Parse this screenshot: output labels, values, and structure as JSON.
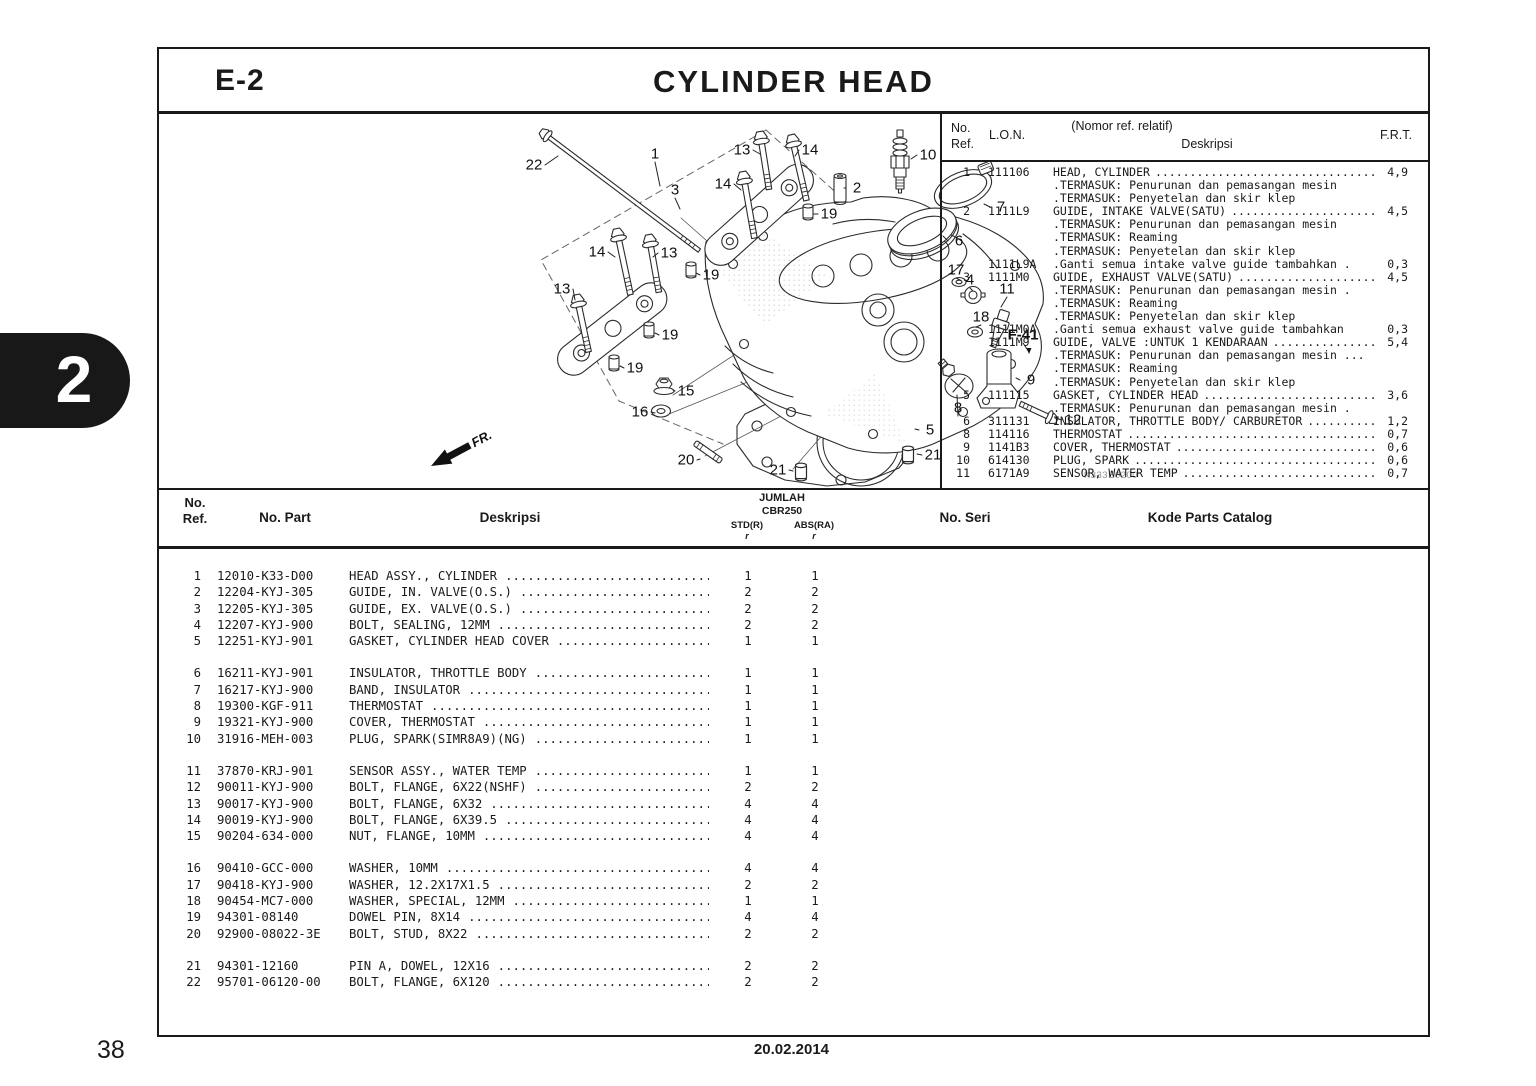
{
  "page": {
    "section_code": "E-2",
    "title": "CYLINDER HEAD",
    "page_number": "38",
    "date": "20.02.2014",
    "chapter_tab": "2"
  },
  "diagram": {
    "code": "K333E0200",
    "fr_label": "FR.",
    "callouts": [
      {
        "t": "22",
        "x": 131,
        "y": 51,
        "tx": 155,
        "ty": 42
      },
      {
        "t": "1",
        "x": 252,
        "y": 40,
        "tx": 257,
        "ty": 72
      },
      {
        "t": "13",
        "x": 339,
        "y": 36,
        "tx": 357,
        "ty": 40
      },
      {
        "t": "14",
        "x": 407,
        "y": 36,
        "tx": 392,
        "ty": 42
      },
      {
        "t": "3",
        "x": 272,
        "y": 76,
        "tx": 277,
        "ty": 95
      },
      {
        "t": "14",
        "x": 320,
        "y": 70,
        "tx": 338,
        "ty": 76
      },
      {
        "t": "2",
        "x": 454,
        "y": 74,
        "tx": 441,
        "ty": 74
      },
      {
        "t": "10",
        "x": 525,
        "y": 41,
        "tx": 508,
        "ty": 45
      },
      {
        "t": "19",
        "x": 426,
        "y": 100,
        "tx": 411,
        "ty": 100
      },
      {
        "t": "7",
        "x": 598,
        "y": 93,
        "tx": 581,
        "ty": 90
      },
      {
        "t": "6",
        "x": 556,
        "y": 127,
        "tx": 540,
        "ty": 122
      },
      {
        "t": "14",
        "x": 194,
        "y": 138,
        "tx": 212,
        "ty": 143
      },
      {
        "t": "13",
        "x": 266,
        "y": 139,
        "tx": 250,
        "ty": 143
      },
      {
        "t": "13",
        "x": 159,
        "y": 175,
        "tx": 172,
        "ty": 186
      },
      {
        "t": "19",
        "x": 308,
        "y": 161,
        "tx": 293,
        "ty": 159
      },
      {
        "t": "19",
        "x": 267,
        "y": 221,
        "tx": 252,
        "ty": 219
      },
      {
        "t": "19",
        "x": 232,
        "y": 254,
        "tx": 217,
        "ty": 252
      },
      {
        "t": "15",
        "x": 283,
        "y": 277,
        "tx": 270,
        "ty": 276
      },
      {
        "t": "16",
        "x": 237,
        "y": 298,
        "tx": 252,
        "ty": 299
      },
      {
        "t": "17",
        "x": 553,
        "y": 156,
        "tx": 557,
        "ty": 166
      },
      {
        "t": "4",
        "x": 567,
        "y": 166,
        "tx": 570,
        "ty": 177
      },
      {
        "t": "11",
        "x": 604,
        "y": 175,
        "tx": 598,
        "ty": 193
      },
      {
        "t": "18",
        "x": 578,
        "y": 203,
        "tx": 573,
        "ty": 213
      },
      {
        "t": "F-41",
        "x": 620,
        "y": 221,
        "b": true,
        "tx": 626,
        "ty": 238
      },
      {
        "t": "9",
        "x": 628,
        "y": 266,
        "tx": 613,
        "ty": 264
      },
      {
        "t": "8",
        "x": 555,
        "y": 294,
        "tx": 554,
        "ty": 281
      },
      {
        "t": "12",
        "x": 670,
        "y": 306,
        "tx": 652,
        "ty": 304
      },
      {
        "t": "5",
        "x": 527,
        "y": 316,
        "tx": 512,
        "ty": 315
      },
      {
        "t": "21",
        "x": 530,
        "y": 341,
        "tx": 514,
        "ty": 340
      },
      {
        "t": "20",
        "x": 283,
        "y": 346,
        "tx": 297,
        "ty": 345
      },
      {
        "t": "21",
        "x": 375,
        "y": 356,
        "tx": 390,
        "ty": 357
      }
    ]
  },
  "lon_table": {
    "header": {
      "ref_line1": "No.",
      "ref_line2": "Ref.",
      "lon": "L.O.N.",
      "desc_line1": "(Nomor ref. relatif)",
      "desc_line2": "Deskripsi",
      "frt": "F.R.T."
    },
    "rows": [
      {
        "ref": "1",
        "lon": "111106",
        "desc": "HEAD, CYLINDER",
        "frt": "4,9",
        "sub": [
          ".TERMASUK: Penurunan dan pemasangan mesin",
          ".TERMASUK: Penyetelan dan skir klep"
        ]
      },
      {
        "ref": "2",
        "lon": "1111L9",
        "desc": "GUIDE, INTAKE VALVE(SATU)",
        "frt": "4,5",
        "sub": [
          ".TERMASUK: Penurunan dan pemasangan mesin",
          ".TERMASUK: Reaming",
          ".TERMASUK: Penyetelan dan skir klep"
        ]
      },
      {
        "ref": "",
        "lon": "1111L9A",
        "desc": ".Ganti semua intake valve guide tambahkan .",
        "frt": "0,3",
        "leader": false
      },
      {
        "ref": "3",
        "lon": "1111M0",
        "desc": "GUIDE, EXHAUST VALVE(SATU)",
        "frt": "4,5",
        "sub": [
          ".TERMASUK: Penurunan dan pemasangan mesin .",
          ".TERMASUK: Reaming",
          ".TERMASUK: Penyetelan dan skir klep"
        ]
      },
      {
        "ref": "",
        "lon": "1111M0A",
        "desc": ".Ganti semua exhaust valve guide tambahkan",
        "frt": "0,3",
        "leader": false
      },
      {
        "ref": "",
        "lon": "1111M9",
        "desc": "GUIDE, VALVE :UNTUK 1 KENDARAAN",
        "frt": "5,4",
        "sub": [
          ".TERMASUK: Penurunan dan pemasangan mesin ...",
          ".TERMASUK: Reaming",
          ".TERMASUK: Penyetelan dan skir klep"
        ]
      },
      {
        "ref": "5",
        "lon": "111115",
        "desc": "GASKET, CYLINDER HEAD",
        "frt": "3,6",
        "sub": [
          ".TERMASUK: Penurunan dan pemasangan mesin ."
        ]
      },
      {
        "ref": "6",
        "lon": "311131",
        "desc": "INSULATOR, THROTTLE BODY/ CARBURETOR",
        "frt": "1,2"
      },
      {
        "ref": "8",
        "lon": "114116",
        "desc": "THERMOSTAT",
        "frt": "0,7"
      },
      {
        "ref": "9",
        "lon": "1141B3",
        "desc": "COVER, THERMOSTAT",
        "frt": "0,6"
      },
      {
        "ref": "10",
        "lon": "614130",
        "desc": "PLUG, SPARK",
        "frt": "0,6"
      },
      {
        "ref": "11",
        "lon": "6171A9",
        "desc": "SENSOR, WATER TEMP",
        "frt": "0,7"
      }
    ]
  },
  "parts_table": {
    "header": {
      "ref_line1": "No.",
      "ref_line2": "Ref.",
      "part": "No. Part",
      "desc": "Deskripsi",
      "jumlah": "JUMLAH",
      "model": "CBR250",
      "std": "STD(R)",
      "abs": "ABS(RA)",
      "std_note": "r",
      "abs_note": "r",
      "seri": "No. Seri",
      "kode": "Kode Parts Catalog"
    },
    "groups": [
      [
        {
          "ref": "1",
          "part": "12010-K33-D00",
          "desc": "HEAD ASSY., CYLINDER",
          "std": "1",
          "abs": "1"
        },
        {
          "ref": "2",
          "part": "12204-KYJ-305",
          "desc": "GUIDE, IN. VALVE(O.S.)",
          "std": "2",
          "abs": "2"
        },
        {
          "ref": "3",
          "part": "12205-KYJ-305",
          "desc": "GUIDE, EX. VALVE(O.S.)",
          "std": "2",
          "abs": "2"
        },
        {
          "ref": "4",
          "part": "12207-KYJ-900",
          "desc": "BOLT, SEALING, 12MM",
          "std": "2",
          "abs": "2"
        },
        {
          "ref": "5",
          "part": "12251-KYJ-901",
          "desc": "GASKET, CYLINDER HEAD COVER",
          "std": "1",
          "abs": "1"
        }
      ],
      [
        {
          "ref": "6",
          "part": "16211-KYJ-901",
          "desc": "INSULATOR, THROTTLE BODY",
          "std": "1",
          "abs": "1"
        },
        {
          "ref": "7",
          "part": "16217-KYJ-900",
          "desc": "BAND, INSULATOR",
          "std": "1",
          "abs": "1"
        },
        {
          "ref": "8",
          "part": "19300-KGF-911",
          "desc": "THERMOSTAT",
          "std": "1",
          "abs": "1"
        },
        {
          "ref": "9",
          "part": "19321-KYJ-900",
          "desc": "COVER, THERMOSTAT",
          "std": "1",
          "abs": "1"
        },
        {
          "ref": "10",
          "part": "31916-MEH-003",
          "desc": "PLUG, SPARK(SIMR8A9)(NG)",
          "std": "1",
          "abs": "1"
        }
      ],
      [
        {
          "ref": "11",
          "part": "37870-KRJ-901",
          "desc": "SENSOR ASSY., WATER TEMP",
          "std": "1",
          "abs": "1"
        },
        {
          "ref": "12",
          "part": "90011-KYJ-900",
          "desc": "BOLT, FLANGE, 6X22(NSHF)",
          "std": "2",
          "abs": "2"
        },
        {
          "ref": "13",
          "part": "90017-KYJ-900",
          "desc": "BOLT, FLANGE, 6X32",
          "std": "4",
          "abs": "4"
        },
        {
          "ref": "14",
          "part": "90019-KYJ-900",
          "desc": "BOLT, FLANGE, 6X39.5",
          "std": "4",
          "abs": "4"
        },
        {
          "ref": "15",
          "part": "90204-634-000",
          "desc": "NUT, FLANGE, 10MM",
          "std": "4",
          "abs": "4"
        }
      ],
      [
        {
          "ref": "16",
          "part": "90410-GCC-000",
          "desc": "WASHER, 10MM",
          "std": "4",
          "abs": "4"
        },
        {
          "ref": "17",
          "part": "90418-KYJ-900",
          "desc": "WASHER, 12.2X17X1.5",
          "std": "2",
          "abs": "2"
        },
        {
          "ref": "18",
          "part": "90454-MC7-000",
          "desc": "WASHER, SPECIAL, 12MM",
          "std": "1",
          "abs": "1"
        },
        {
          "ref": "19",
          "part": "94301-08140",
          "desc": "DOWEL PIN, 8X14",
          "std": "4",
          "abs": "4"
        },
        {
          "ref": "20",
          "part": "92900-08022-3E",
          "desc": "BOLT, STUD, 8X22",
          "std": "2",
          "abs": "2"
        }
      ],
      [
        {
          "ref": "21",
          "part": "94301-12160",
          "desc": "PIN A, DOWEL, 12X16",
          "std": "2",
          "abs": "2"
        },
        {
          "ref": "22",
          "part": "95701-06120-00",
          "desc": "BOLT, FLANGE, 6X120",
          "std": "2",
          "abs": "2"
        }
      ]
    ]
  }
}
